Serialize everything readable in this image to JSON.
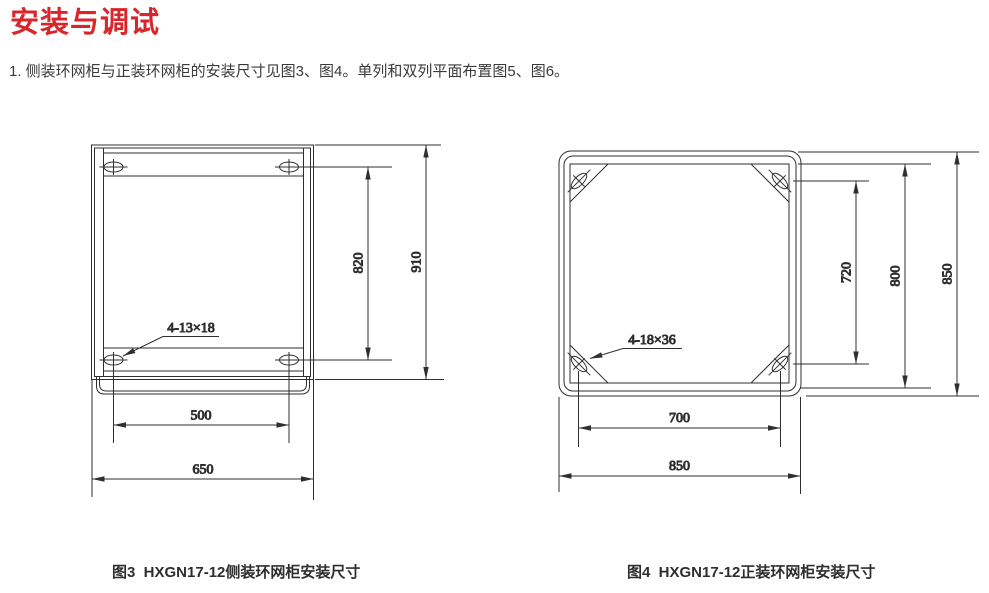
{
  "colors": {
    "accent_red": "#d7262c",
    "line": "#2f2f2f",
    "body_text": "#3a3a3a"
  },
  "header": {
    "title": "安装与调试"
  },
  "intro": {
    "text": "1. 侧装环网柜与正装环网柜的安装尺寸见图3、图4。单列和双列平面布置图5、图6。"
  },
  "fig3": {
    "caption": "图3  HXGN17-12侧装环网柜安装尺寸",
    "dims": {
      "slot_label": "4-13×18",
      "vertical_hole_spacing": "820",
      "overall_height": "910",
      "horizontal_hole_spacing": "500",
      "overall_width": "650"
    }
  },
  "fig4": {
    "caption": "图4  HXGN17-12正装环网柜安装尺寸",
    "dims": {
      "slot_label": "4-18×36",
      "vertical_hole_spacing": "720",
      "frame_height": "800",
      "overall_height": "850",
      "horizontal_hole_spacing": "700",
      "overall_width": "850"
    }
  }
}
